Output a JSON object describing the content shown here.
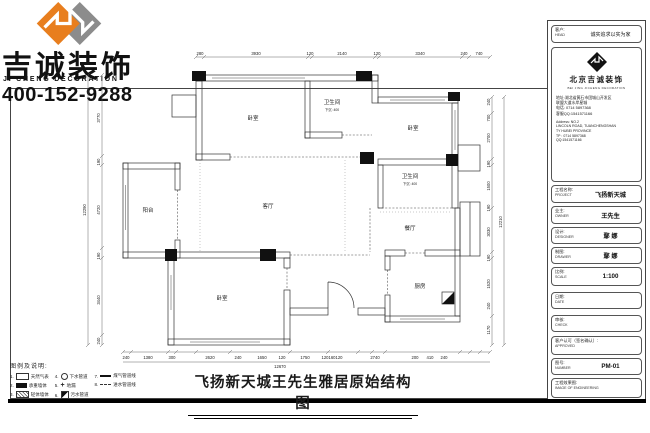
{
  "brand": {
    "name_cn": "吉诚装饰",
    "name_en": "JI CHENG DECORATION",
    "phone": "400-152-9288",
    "colors": {
      "logo_orange": "#E87E1E",
      "logo_gray": "#8C8C8C",
      "line": "#333333"
    }
  },
  "title_bar": {
    "title": "飞扬新天城王先生雅居原始结构图"
  },
  "legend": {
    "heading": "图例及说明:",
    "items": [
      {
        "no": "1.",
        "icon": "rect-outline-icon",
        "label": "天然气表"
      },
      {
        "no": "2.",
        "icon": "rect-filled-icon",
        "label": "承重墙体"
      },
      {
        "no": "3.",
        "icon": "rect-hatched-icon",
        "label": "轻体墙体"
      },
      {
        "no": "4.",
        "icon": "circle-icon",
        "label": "下水管道"
      },
      {
        "no": "5.",
        "icon": "plus-icon",
        "label": "地漏"
      },
      {
        "no": "6.",
        "icon": "corner-square-icon",
        "label": "污水管道"
      },
      {
        "no": "7.",
        "icon": "solid-line-icon",
        "label": "煤气管道线"
      },
      {
        "no": "8.",
        "icon": "dashed-line-icon",
        "label": "进水管道线"
      }
    ],
    "plus_glyph": "+"
  },
  "plan": {
    "rooms": {
      "bedroom_tl": "卧室",
      "bath1": "卫生间",
      "bath1_note": "下沉: 400",
      "bedroom_tr": "卧室",
      "bath2": "卫生间",
      "bath2_note": "下沉: 400",
      "living": "客厅",
      "dining": "餐厅",
      "kitchen": "厨房",
      "balcony": "阳台",
      "bedroom_bl": "卧室"
    },
    "dims": {
      "top": [
        "280",
        "3930",
        "120",
        "2140",
        "120",
        "3340",
        "240",
        "740"
      ],
      "left": [
        "3770",
        "190",
        "4720",
        "190",
        "3440",
        "240"
      ],
      "left_total": "12290",
      "right": [
        "240",
        "700",
        "2700",
        "190",
        "1500",
        "190",
        "3030",
        "190",
        "1520",
        "240",
        "1170"
      ],
      "right_total": "12210",
      "bottom": [
        "240",
        "1380",
        "300",
        "2620",
        "240",
        "1650",
        "120",
        "1750",
        "120",
        "160",
        "120",
        "2740",
        "200",
        "410",
        "240"
      ],
      "bottom_total": "12670"
    }
  },
  "title_block": {
    "customer": {
      "label": "客户:",
      "sub": "HEAD",
      "value": "诚实追求以实为家"
    },
    "company": {
      "name": "北京吉诚装饰",
      "name_en": "BEI JING JICHENG DECORATION",
      "addr1": "地址:湖北省黄石市团城山开发区",
      "addr2": "联盟大道水岸星城",
      "phone": "电话: 0714 5897368",
      "qq": "客服QQ:1541571166",
      "en_addr1": "Address: NO.2",
      "en_addr2": "LINCOLN ROAD, TUANCHENGSHAN",
      "en_addr3": "TY HUBEI PROVINCE",
      "en_tp": "TP : 0714 5897368",
      "en_qq": "QQ:1541571166"
    },
    "fields": [
      {
        "label": "工程名称:",
        "sub": "PROJECT",
        "value": "飞扬新天城"
      },
      {
        "label": "业主:",
        "sub": "OWNER",
        "value": "王先生"
      },
      {
        "label": "设计:",
        "sub": "DESIGNER",
        "value": "鄢 娜"
      },
      {
        "label": "制图:",
        "sub": "DRAWER",
        "value": "鄢 娜"
      },
      {
        "label": "比例:",
        "sub": "SCALE",
        "value": "1:100"
      },
      {
        "label": "日期:",
        "sub": "DATE",
        "value": ""
      },
      {
        "label": "审核:",
        "sub": "CHECK",
        "value": ""
      },
      {
        "label": "客户认可（签名确认）:",
        "sub": "APPROVED",
        "value": ""
      },
      {
        "label": "图号:",
        "sub": "NUMBER",
        "value": "PM-01"
      },
      {
        "label": "工程效果图:",
        "sub": "IMAGE OF ENGINEERING",
        "value": ""
      }
    ]
  }
}
